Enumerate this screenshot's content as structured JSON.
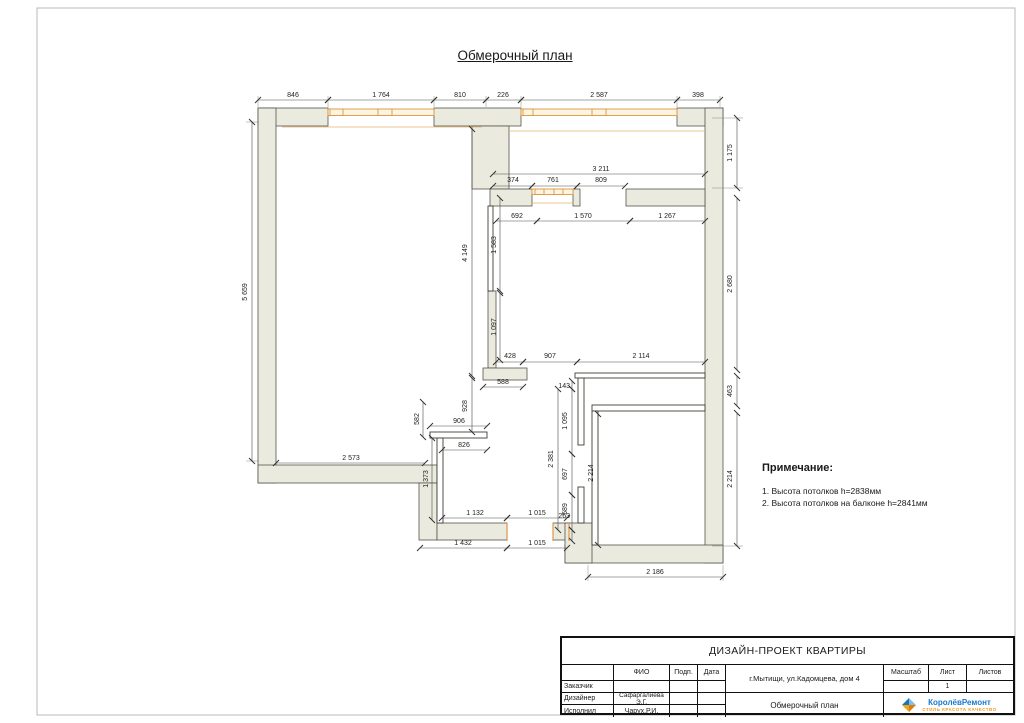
{
  "page": {
    "title": "Обмерочный план"
  },
  "dims": [
    "846",
    "1 764",
    "810",
    "226",
    "2 587",
    "398",
    "3 211",
    "374",
    "761",
    "809",
    "692",
    "1 570",
    "1 267",
    "428",
    "907",
    "2 114",
    "588",
    "906",
    "826",
    "2 573",
    "1 132",
    "1 015",
    "263",
    "1 432",
    "1 015",
    "2 186",
    "5 659",
    "1 175",
    "2 680",
    "463",
    "2 214",
    "4 149",
    "1 583",
    "1 097",
    "928",
    "143",
    "1 095",
    "2 381",
    "697",
    "589",
    "2 214",
    "582",
    "1 373"
  ],
  "notes": {
    "heading": "Примечание:",
    "items": [
      "1. Высота потолков h=2838мм",
      "2. Высота потолков на балконе h=2841мм"
    ]
  },
  "titleblock": {
    "project": "ДИЗАЙН-ПРОЕКТ КВАРТИРЫ",
    "headers": {
      "fio": "ФИО",
      "sign": "Подп.",
      "date": "Дата",
      "scale": "Масштаб",
      "sheet": "Лист",
      "sheets": "Листов"
    },
    "address": "г.Мытищи, ул.Кадомцева, дом 4",
    "rows": [
      {
        "role": "Заказчик",
        "name": ""
      },
      {
        "role": "Дизайнер",
        "name": "Сафаргалиева Э.Г."
      },
      {
        "role": "Исполнил",
        "name": "Чарух.Р.И."
      }
    ],
    "doc_title": "Обмерочный план",
    "sheet_number": "1",
    "logo": {
      "name": "КоролёвРемонт",
      "tagline": "СТИЛЬ КРАСОТА КАЧЕСТВО"
    }
  }
}
